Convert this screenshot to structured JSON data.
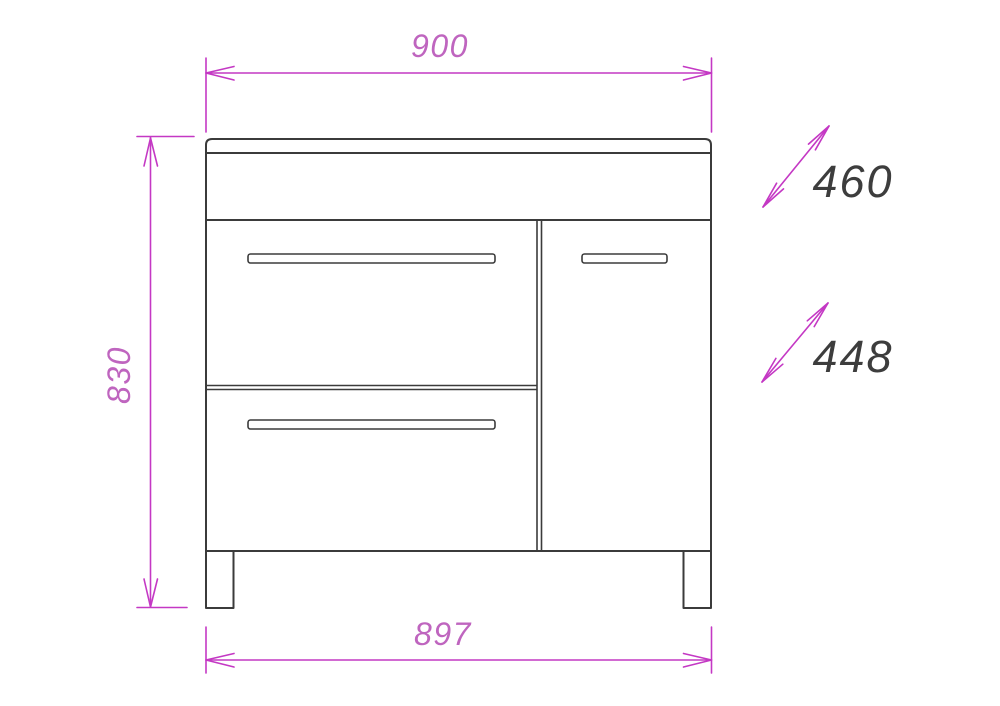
{
  "drawing": {
    "subject": "vanity-cabinet-front-elevation"
  },
  "dimensions": {
    "overall_width": "900",
    "overall_height": "830",
    "base_width": "897",
    "depth_top": "460",
    "depth_bottom": "448"
  },
  "colors": {
    "dimension_line": "#c438c4",
    "dimension_text": "#bf65bf",
    "depth_text": "#3d3d3d",
    "drawing_line": "#3b3b3b",
    "background": "#ffffff"
  }
}
